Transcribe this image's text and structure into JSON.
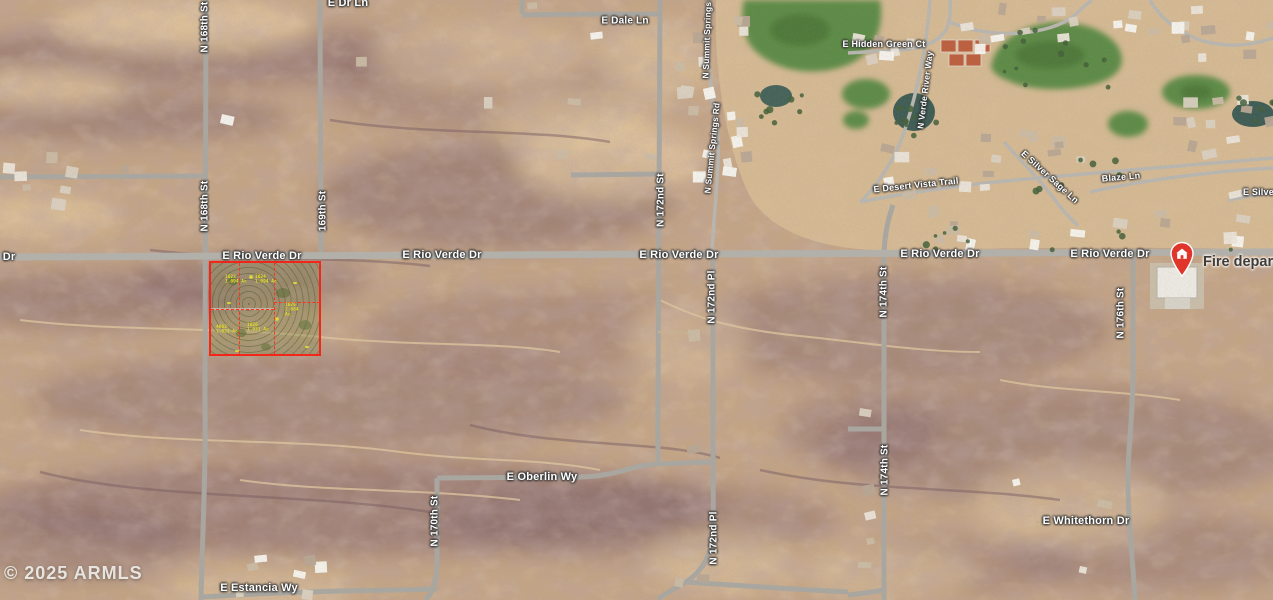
{
  "map": {
    "attribution": "© 2025 ARMLS",
    "poi": {
      "fire": "Fire depart"
    },
    "roads": {
      "rio_verde": "E Rio Verde Dr",
      "rio_verde_partial": "Dr",
      "dr_ln": "E Dr Ln",
      "dale": "E Dale Ln",
      "hidden_green": "E Hidden Green Ct",
      "verde_river": "N Verde River Way",
      "summit_springs": "N Summit Springs Rd",
      "desert_vista": "E Desert Vista Trail",
      "silver_sage": "E Silver Sage Ln",
      "silver_partial": "E Silver",
      "blaze": "Blaze Ln",
      "st168": "N 168th St",
      "st169": "169th St",
      "st170": "N 170th St",
      "st172": "N 172nd St",
      "pl172": "N 172nd Pl",
      "st174": "N 174th St",
      "st176": "N 176th St",
      "oberlin": "E Oberlin Wy",
      "whitethorn": "E Whitethorn Dr",
      "estancia": "E Estancia Wy"
    },
    "parcel": {
      "outline_color": "#f2271a",
      "lots": [
        {
          "id": "1623",
          "area": "1.094 Ac"
        },
        {
          "id": "1624",
          "area": "1.094 Ac"
        },
        {
          "id": "1625",
          "area": "2.084 Ac"
        },
        {
          "id": "4603",
          "area": "1.031 Ac"
        },
        {
          "id": "1626",
          "area": "1.031 Ac"
        }
      ]
    },
    "colors": {
      "desert": "#c4a585",
      "road": "#a9a7a1",
      "golf": "#5d8b46",
      "pin": "#e0352b"
    }
  }
}
